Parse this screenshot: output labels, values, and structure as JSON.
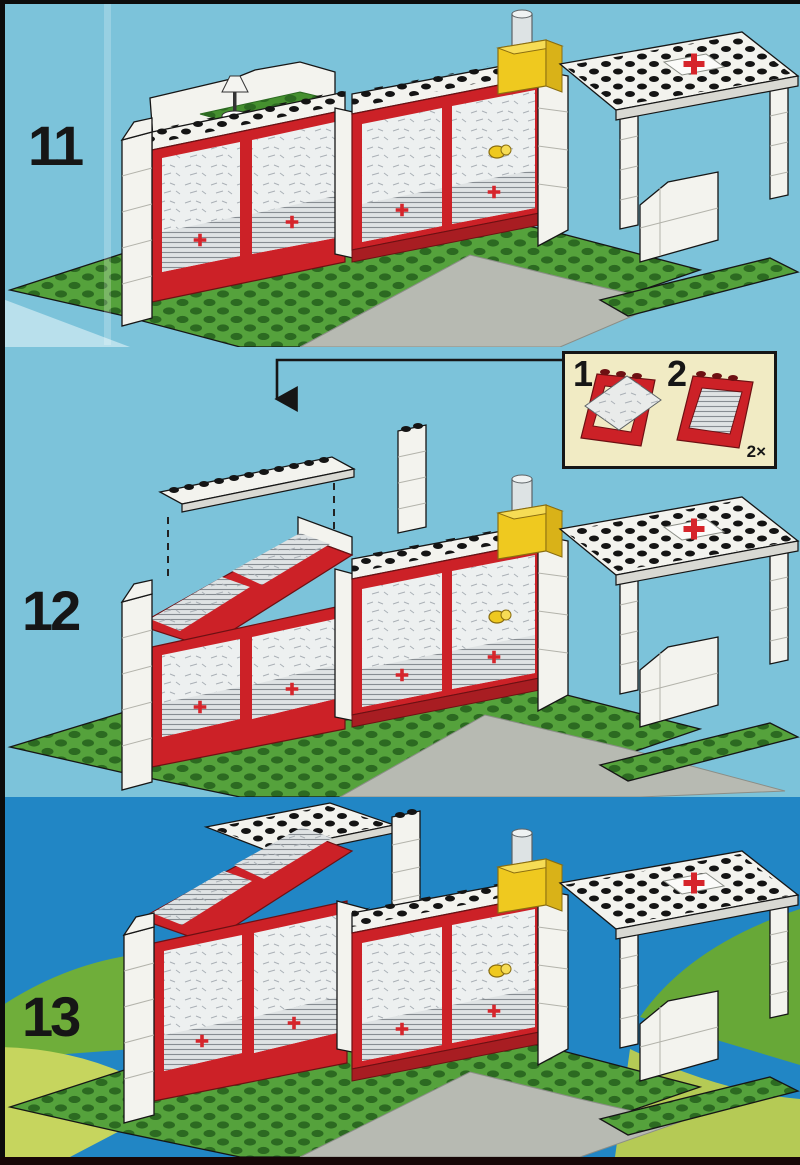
{
  "steps": [
    {
      "label": "11"
    },
    {
      "label": "12"
    },
    {
      "label": "13"
    }
  ],
  "inset": {
    "substep1": "1",
    "substep2": "2",
    "quantity": "2×"
  },
  "icons": [
    "red-cross-icon",
    "insert-arrow-icon",
    "beacon-light",
    "interior-lamp",
    "stud-grid"
  ],
  "colors": {
    "page_blue": "#7cc3da",
    "panel3_sky_blue": "#2186c5",
    "hill_green": "#6fae3a",
    "hill_yellow_green": "#bfd058",
    "baseplate_green": "#55a23c",
    "stud_dark_green": "#2c6a21",
    "brick_white": "#f3f3ee",
    "brick_shadow": "#d9d9d3",
    "lego_red": "#cc2127",
    "lego_red_dark": "#a81d22",
    "lego_yellow": "#efc91f",
    "driveway_gray": "#b7bab2",
    "inset_cream": "#f1ebc4",
    "cross_red": "#d6252b",
    "outline_black": "#161616"
  }
}
